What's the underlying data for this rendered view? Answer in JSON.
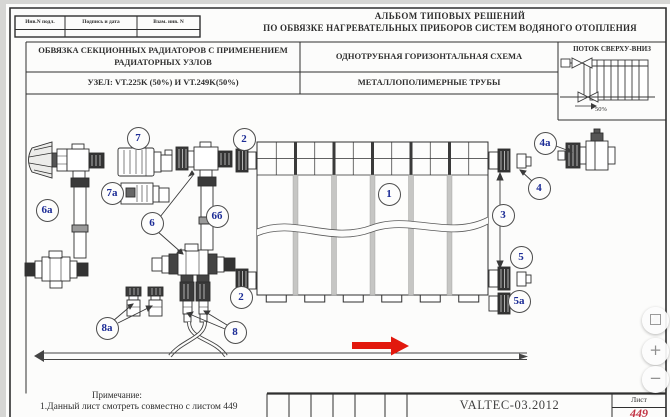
{
  "viewer": {
    "controls": [
      {
        "name": "fullscreen",
        "glyph": ""
      },
      {
        "name": "zoom-in",
        "glyph": "+"
      },
      {
        "name": "zoom-out",
        "glyph": "−"
      }
    ]
  },
  "header": {
    "stamp_columns": [
      "Инв.N подл.",
      "Подпись и дата",
      "Взам. инв. N"
    ],
    "album_title_line1": "АЛЬБОМ ТИПОВЫХ РЕШЕНИЙ",
    "album_title_line2": "ПО ОБВЯЗКЕ НАГРЕВАТЕЛЬНЫХ ПРИБОРОВ СИСТЕМ ВОДЯНОГО ОТОПЛЕНИЯ",
    "scheme_block_title_line1": "ОБВЯЗКА СЕКЦИОННЫХ РАДИАТОРОВ С ПРИМЕНЕНИЕМ",
    "scheme_block_title_line2": "РАДИАТОРНЫХ УЗЛОВ",
    "node_row": "УЗЕЛ: VT.225K (50%) И VT.249K(50%)",
    "scheme_type": "ОДНОТРУБНАЯ ГОРИЗОНТАЛЬНАЯ СХЕМА",
    "pipe_type": "МЕТАЛЛОПОЛИМЕРНЫЕ ТРУБЫ",
    "flow_box": {
      "title": "ПОТОК СВЕРХУ-ВНИЗ",
      "percent_label": "50%"
    }
  },
  "callouts": {
    "c1": "1",
    "c2_top": "2",
    "c2_bottom": "2",
    "c3": "3",
    "c4": "4",
    "c4a": "4a",
    "c5": "5",
    "c5a": "5a",
    "c6": "6",
    "c6a": "6a",
    "c6b": "6б",
    "c7": "7",
    "c7a": "7a",
    "c8": "8",
    "c8a": "8a"
  },
  "notes": {
    "title": "Примечание:",
    "line1": "1.Данный лист смотреть совместно с листом 449"
  },
  "title_block": {
    "document_code": "VALTEC-03.2012",
    "sheet_label": "Лист",
    "sheet_number": "449"
  },
  "colors": {
    "callout_blue": "#1c2c96",
    "flow_arrow_red": "#e2180d",
    "sheet_number_red": "#c23243",
    "line_dark": "#2f2f2f"
  }
}
